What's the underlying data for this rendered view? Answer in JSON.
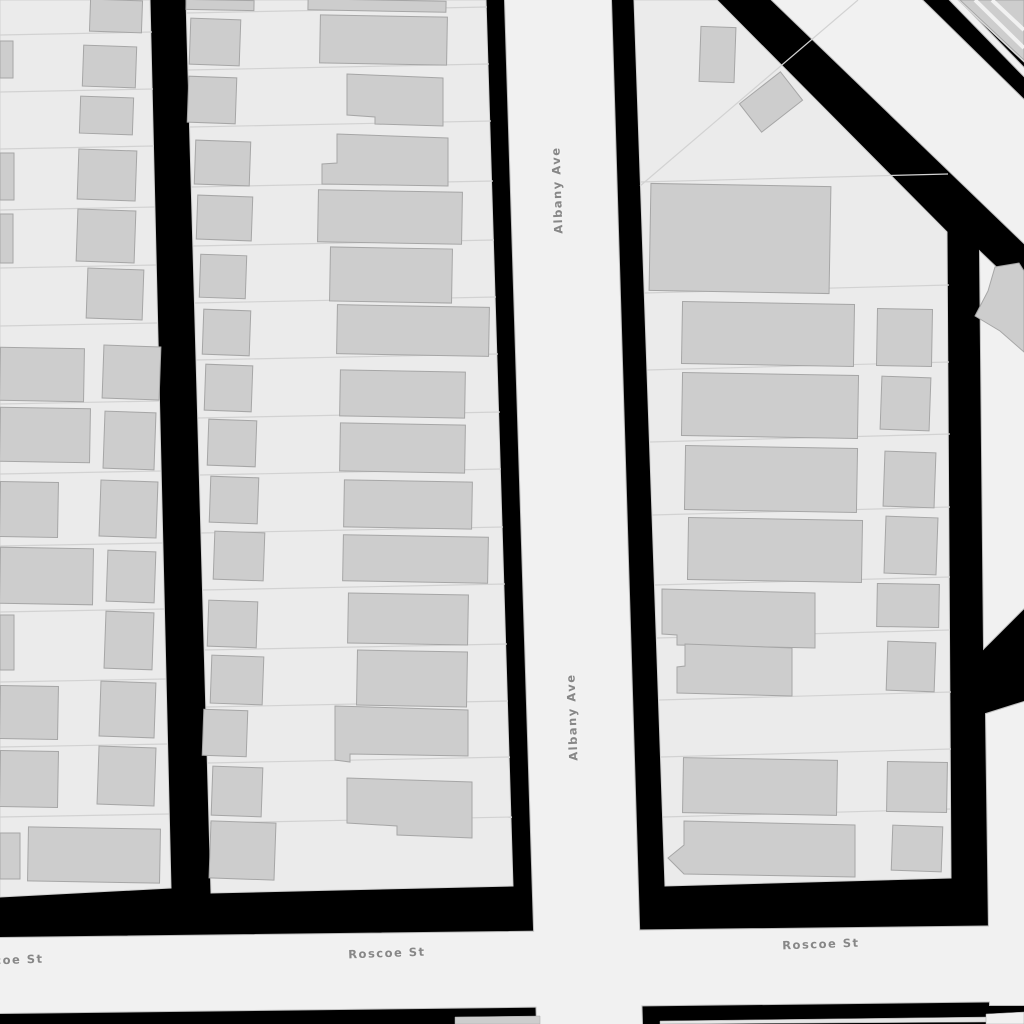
{
  "map": {
    "colors": {
      "background": "#000000",
      "street_fill": "#f1f1f1",
      "street_casing": "#bfbfbf",
      "block_fill": "#ebebeb",
      "block_stroke": "#d0d0d0",
      "building_fill": "#cdcdcd",
      "building_stroke": "#a6a6a6",
      "parcel_stroke": "#d2d2d2",
      "label_color": "#878787",
      "label_halo": "#f2f2f2"
    },
    "labels": [
      {
        "text": "Albany Ave",
        "x": 561,
        "y": 190,
        "rotation": -92
      },
      {
        "text": "Albany Ave",
        "x": 576,
        "y": 717,
        "rotation": -92
      },
      {
        "text": "Roscoe St",
        "x": 5,
        "y": 964,
        "rotation": -2
      },
      {
        "text": "Roscoe St",
        "x": 387,
        "y": 957,
        "rotation": -2
      },
      {
        "text": "Roscoe St",
        "x": 821,
        "y": 948,
        "rotation": -2
      }
    ],
    "streets": [
      {
        "id": "street-albany-ave",
        "points": [
          [
            505,
            0
          ],
          [
            611,
            0
          ],
          [
            642,
            1024
          ],
          [
            537,
            1024
          ]
        ]
      },
      {
        "id": "street-roscoe-st",
        "points": [
          [
            0,
            938
          ],
          [
            1024,
            926
          ],
          [
            1024,
            1001
          ],
          [
            0,
            1013
          ]
        ]
      },
      {
        "id": "street-diagonal-corridor",
        "points": [
          [
            772,
            0
          ],
          [
            922,
            0
          ],
          [
            1024,
            100
          ],
          [
            1024,
            243
          ]
        ]
      },
      {
        "id": "street-right-upper",
        "points": [
          [
            980,
            252
          ],
          [
            1024,
            294
          ],
          [
            1024,
            608
          ],
          [
            984,
            648
          ]
        ]
      },
      {
        "id": "street-right-lower",
        "points": [
          [
            986,
            714
          ],
          [
            1024,
            702
          ],
          [
            1024,
            1005
          ],
          [
            990,
            1005
          ]
        ]
      },
      {
        "id": "street-corner-sliver",
        "points": [
          [
            950,
            0
          ],
          [
            958,
            0
          ],
          [
            1024,
            68
          ],
          [
            1024,
            76
          ]
        ]
      }
    ],
    "blocks": [
      {
        "id": "block-left",
        "points": [
          [
            0,
            0
          ],
          [
            150,
            0
          ],
          [
            171,
            888
          ],
          [
            0,
            897
          ]
        ]
      },
      {
        "id": "block-middle",
        "points": [
          [
            186,
            0
          ],
          [
            486,
            0
          ],
          [
            513,
            886
          ],
          [
            211,
            893
          ]
        ]
      },
      {
        "id": "block-right",
        "points": [
          [
            634,
            0
          ],
          [
            717,
            0
          ],
          [
            947,
            232
          ],
          [
            951,
            878
          ],
          [
            665,
            886
          ]
        ]
      },
      {
        "id": "block-corner",
        "points": [
          [
            958,
            0
          ],
          [
            1024,
            0
          ],
          [
            1024,
            62
          ]
        ]
      }
    ],
    "parcel_lines": [
      [
        0,
        35,
        152,
        32
      ],
      [
        0,
        92,
        153,
        89
      ],
      [
        0,
        149,
        154,
        146
      ],
      [
        0,
        210,
        155,
        207
      ],
      [
        0,
        268,
        156,
        265
      ],
      [
        0,
        326,
        157,
        323
      ],
      [
        0,
        404,
        159,
        401
      ],
      [
        0,
        474,
        161,
        471
      ],
      [
        0,
        546,
        163,
        543
      ],
      [
        0,
        612,
        164,
        609
      ],
      [
        0,
        682,
        166,
        679
      ],
      [
        0,
        747,
        167,
        744
      ],
      [
        0,
        817,
        169,
        814
      ],
      [
        186,
        13,
        487,
        7
      ],
      [
        188,
        70,
        489,
        64
      ],
      [
        190,
        127,
        491,
        121
      ],
      [
        191,
        187,
        493,
        181
      ],
      [
        193,
        246,
        494,
        240
      ],
      [
        195,
        303,
        496,
        297
      ],
      [
        196,
        360,
        498,
        354
      ],
      [
        198,
        418,
        500,
        412
      ],
      [
        200,
        475,
        501,
        469
      ],
      [
        201,
        533,
        503,
        527
      ],
      [
        203,
        590,
        505,
        584
      ],
      [
        205,
        650,
        507,
        644
      ],
      [
        206,
        707,
        508,
        701
      ],
      [
        208,
        763,
        510,
        757
      ],
      [
        210,
        823,
        512,
        817
      ],
      [
        640,
        182,
        948,
        174
      ],
      [
        644,
        293,
        949,
        285
      ],
      [
        647,
        370,
        949,
        362
      ],
      [
        650,
        442,
        950,
        434
      ],
      [
        652,
        515,
        950,
        507
      ],
      [
        655,
        585,
        950,
        577
      ],
      [
        657,
        638,
        950,
        630
      ],
      [
        659,
        700,
        951,
        692
      ],
      [
        661,
        757,
        951,
        749
      ],
      [
        663,
        817,
        951,
        809
      ],
      [
        640,
        186,
        858,
        0
      ]
    ],
    "buildings": {
      "rects": [
        [
          90,
          0,
          52,
          32,
          2
        ],
        [
          0,
          41,
          13,
          37,
          0
        ],
        [
          83,
          46,
          53,
          41,
          2
        ],
        [
          80,
          97,
          53,
          37,
          2
        ],
        [
          0,
          153,
          14,
          47,
          0
        ],
        [
          78,
          150,
          58,
          50,
          2
        ],
        [
          0,
          214,
          13,
          49,
          0
        ],
        [
          77,
          210,
          58,
          52,
          2
        ],
        [
          87,
          269,
          56,
          50,
          2
        ],
        [
          0,
          348,
          84,
          53,
          1
        ],
        [
          103,
          346,
          57,
          53,
          2
        ],
        [
          0,
          408,
          90,
          54,
          1
        ],
        [
          104,
          412,
          51,
          57,
          2
        ],
        [
          0,
          482,
          58,
          55,
          1
        ],
        [
          100,
          481,
          57,
          56,
          2
        ],
        [
          0,
          548,
          93,
          56,
          1
        ],
        [
          107,
          551,
          48,
          51,
          2
        ],
        [
          0,
          615,
          14,
          55,
          0
        ],
        [
          105,
          612,
          48,
          57,
          2
        ],
        [
          0,
          686,
          58,
          53,
          1
        ],
        [
          100,
          682,
          55,
          55,
          2
        ],
        [
          0,
          751,
          58,
          56,
          1
        ],
        [
          98,
          747,
          57,
          58,
          2
        ],
        [
          28,
          828,
          132,
          54,
          1
        ],
        [
          0,
          833,
          20,
          46,
          0
        ],
        [
          186,
          0,
          68,
          10,
          1
        ],
        [
          308,
          0,
          138,
          11,
          1
        ],
        [
          190,
          19,
          50,
          46,
          2
        ],
        [
          320,
          16,
          127,
          48,
          1
        ],
        [
          188,
          77,
          48,
          46,
          2
        ],
        [
          195,
          141,
          55,
          44,
          2
        ],
        [
          197,
          196,
          55,
          44,
          2
        ],
        [
          318,
          191,
          144,
          52,
          1
        ],
        [
          200,
          255,
          46,
          43,
          2
        ],
        [
          330,
          248,
          122,
          54,
          1
        ],
        [
          203,
          310,
          47,
          45,
          2
        ],
        [
          337,
          306,
          152,
          49,
          1
        ],
        [
          205,
          365,
          47,
          46,
          2
        ],
        [
          340,
          371,
          125,
          46,
          1
        ],
        [
          208,
          420,
          48,
          46,
          2
        ],
        [
          340,
          424,
          125,
          48,
          1
        ],
        [
          210,
          477,
          48,
          46,
          2
        ],
        [
          344,
          481,
          128,
          47,
          1
        ],
        [
          214,
          532,
          50,
          48,
          2
        ],
        [
          343,
          536,
          145,
          46,
          1
        ],
        [
          208,
          601,
          49,
          46,
          2
        ],
        [
          348,
          594,
          120,
          50,
          1
        ],
        [
          211,
          656,
          52,
          48,
          2
        ],
        [
          357,
          651,
          110,
          55,
          1
        ],
        [
          203,
          710,
          44,
          46,
          2
        ],
        [
          212,
          767,
          50,
          49,
          2
        ],
        [
          210,
          822,
          65,
          57,
          2
        ],
        [
          650,
          185,
          180,
          107,
          1
        ],
        [
          700,
          27,
          35,
          55,
          2
        ],
        [
          745,
          84,
          52,
          36,
          -38
        ],
        [
          682,
          303,
          172,
          62,
          1
        ],
        [
          877,
          309,
          55,
          57,
          1
        ],
        [
          682,
          374,
          176,
          63,
          1
        ],
        [
          881,
          377,
          49,
          53,
          2
        ],
        [
          685,
          447,
          172,
          64,
          1
        ],
        [
          884,
          452,
          51,
          55,
          2
        ],
        [
          688,
          519,
          174,
          62,
          1
        ],
        [
          885,
          517,
          52,
          57,
          2
        ],
        [
          877,
          584,
          62,
          43,
          1
        ],
        [
          887,
          642,
          48,
          49,
          2
        ],
        [
          683,
          759,
          154,
          55,
          1
        ],
        [
          887,
          762,
          60,
          50,
          1
        ],
        [
          892,
          826,
          50,
          45,
          2
        ]
      ],
      "polys": [
        [
          [
            347,
            74
          ],
          [
            443,
            78
          ],
          [
            443,
            126
          ],
          [
            375,
            124
          ],
          [
            375,
            117
          ],
          [
            347,
            115
          ]
        ],
        [
          [
            337,
            134
          ],
          [
            448,
            138
          ],
          [
            448,
            186
          ],
          [
            322,
            184
          ],
          [
            322,
            164
          ],
          [
            337,
            163
          ]
        ],
        [
          [
            335,
            706
          ],
          [
            468,
            710
          ],
          [
            468,
            756
          ],
          [
            350,
            754
          ],
          [
            350,
            762
          ],
          [
            335,
            760
          ]
        ],
        [
          [
            347,
            778
          ],
          [
            472,
            782
          ],
          [
            472,
            838
          ],
          [
            397,
            835
          ],
          [
            397,
            826
          ],
          [
            347,
            823
          ]
        ],
        [
          [
            662,
            589
          ],
          [
            815,
            593
          ],
          [
            815,
            648
          ],
          [
            677,
            645
          ],
          [
            677,
            635
          ],
          [
            662,
            634
          ]
        ],
        [
          [
            685,
            644
          ],
          [
            792,
            648
          ],
          [
            792,
            696
          ],
          [
            677,
            693
          ],
          [
            677,
            667
          ],
          [
            685,
            666
          ]
        ],
        [
          [
            684,
            821
          ],
          [
            855,
            825
          ],
          [
            855,
            877
          ],
          [
            684,
            874
          ],
          [
            668,
            858
          ],
          [
            684,
            845
          ]
        ],
        [
          [
            960,
            0
          ],
          [
            1024,
            0
          ],
          [
            1024,
            60
          ]
        ],
        [
          [
            995,
            267
          ],
          [
            1019,
            263
          ],
          [
            1024,
            271
          ],
          [
            1024,
            352
          ],
          [
            1000,
            331
          ],
          [
            975,
            316
          ],
          [
            988,
            291
          ]
        ]
      ]
    },
    "corner_stripes": [
      [
        975,
        0,
        1024,
        48
      ],
      [
        992,
        0,
        1024,
        30
      ]
    ],
    "slivers": [
      {
        "points": [
          [
            455,
            1017
          ],
          [
            540,
            1016
          ],
          [
            540,
            1024
          ],
          [
            455,
            1024
          ]
        ],
        "fill": "#cdcdcd"
      },
      {
        "points": [
          [
            660,
            1021
          ],
          [
            988,
            1017
          ],
          [
            988,
            1022
          ],
          [
            660,
            1024
          ]
        ],
        "fill": "#e6e6e6"
      },
      {
        "points": [
          [
            986,
            1014
          ],
          [
            1024,
            1012
          ],
          [
            1024,
            1024
          ],
          [
            986,
            1024
          ]
        ],
        "fill": "#f1f1f1"
      }
    ]
  }
}
